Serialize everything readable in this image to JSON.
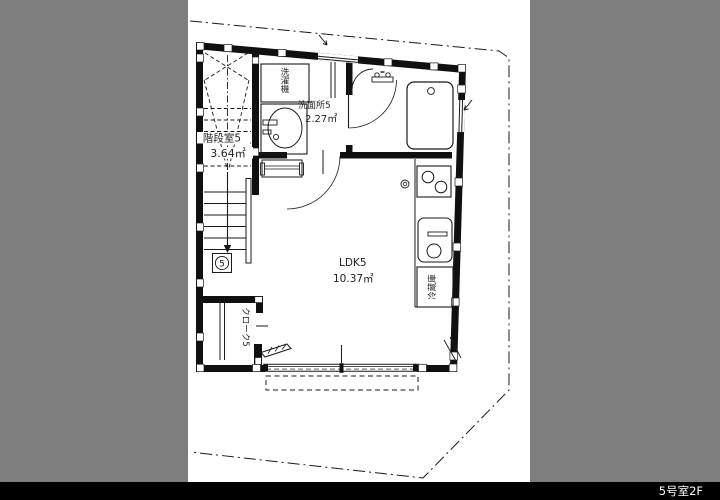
{
  "page": {
    "background_color": "#7d7d7d",
    "paper_color": "#ffffff",
    "line_color": "#1a1a1a"
  },
  "footer": {
    "caption": "5号室2F",
    "bg_color": "#000000",
    "text_color": "#ffffff"
  },
  "plan": {
    "stairwell": {
      "label": "階段室5",
      "area": "3.64㎡",
      "marker": "5"
    },
    "washroom": {
      "label": "洗面所5",
      "area": "2.27㎡"
    },
    "ldk": {
      "label": "LDK5",
      "area": "10.37㎡"
    },
    "closet": {
      "label": "クローク5"
    },
    "fixtures": {
      "washing_machine": "洗濯機",
      "refrigerator": "冷蔵庫"
    }
  }
}
